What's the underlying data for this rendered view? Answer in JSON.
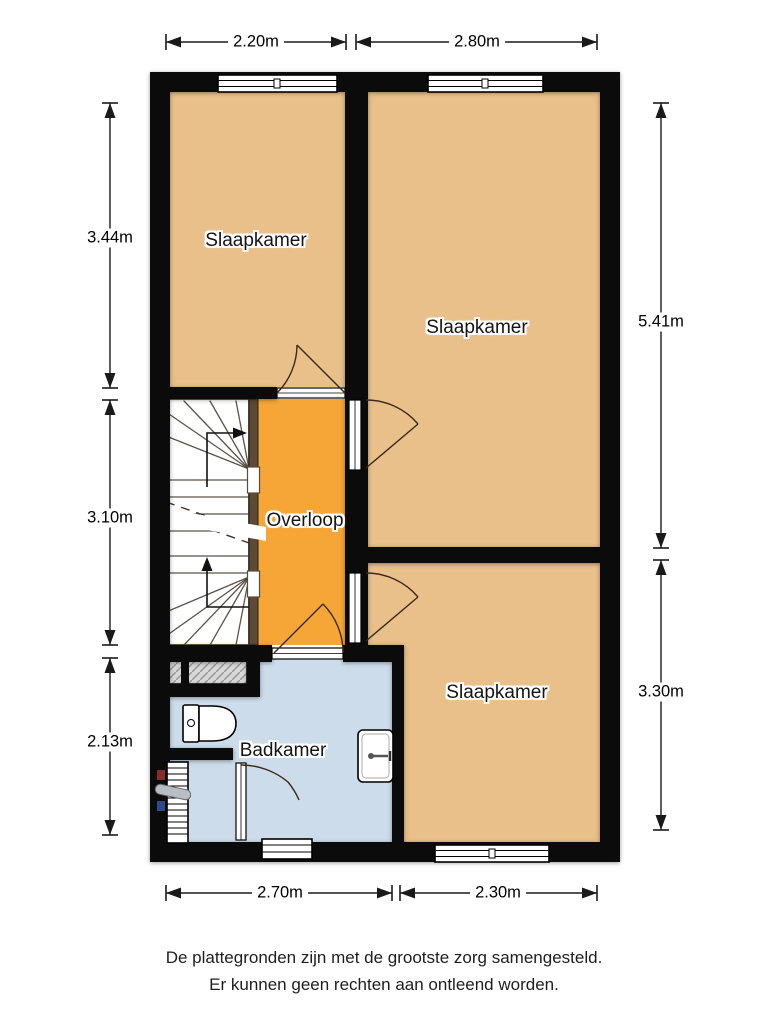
{
  "floorplan": {
    "rooms": [
      {
        "name": "bedroom-top-left",
        "label": "Slaapkamer"
      },
      {
        "name": "bedroom-right",
        "label": "Slaapkamer"
      },
      {
        "name": "bedroom-bottom-right",
        "label": "Slaapkamer"
      },
      {
        "name": "landing",
        "label": "Overloop"
      },
      {
        "name": "bathroom",
        "label": "Badkamer"
      }
    ],
    "dimensions": {
      "top": [
        "2.20m",
        "2.80m"
      ],
      "bottom": [
        "2.70m",
        "2.30m"
      ],
      "left": [
        "3.44m",
        "3.10m",
        "2.13m"
      ],
      "right": [
        "5.41m",
        "3.30m"
      ]
    },
    "disclaimer": {
      "line1": "De plattegronden zijn met de grootste zorg samengesteld.",
      "line2": "Er kunnen geen rechten aan ontleend worden."
    },
    "colors": {
      "room": "#e9c08a",
      "landing": "#f6a637",
      "bathroom": "#cddcea",
      "wall": "#0b0b0b"
    }
  }
}
